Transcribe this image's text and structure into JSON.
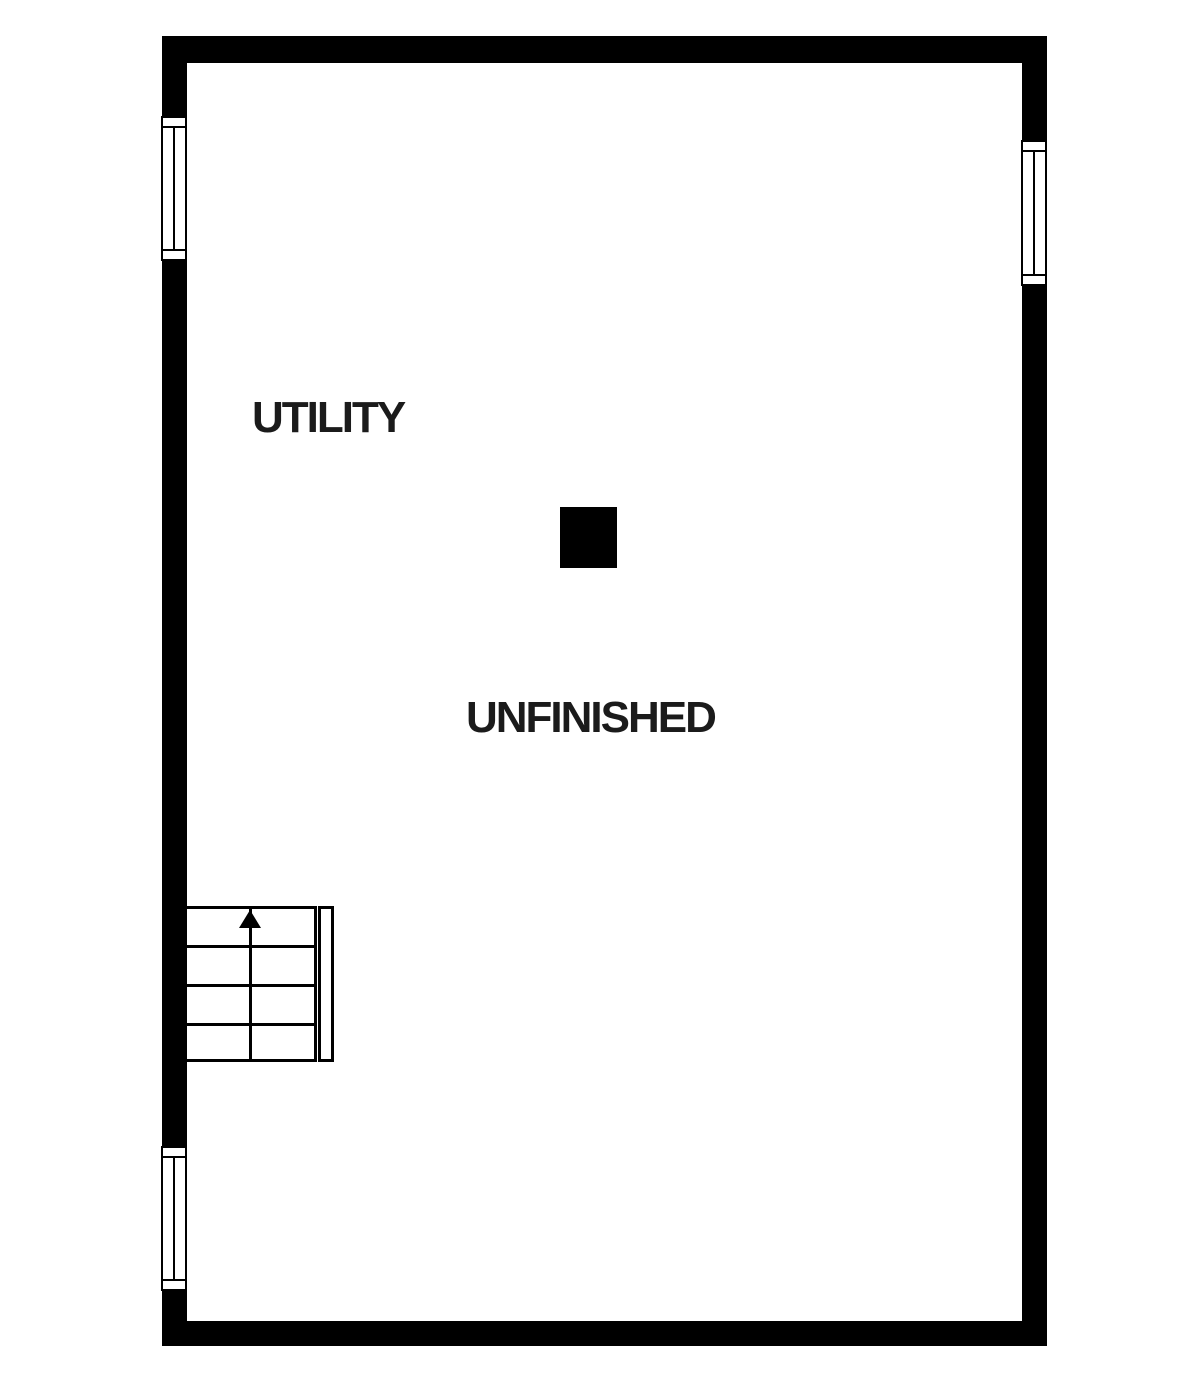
{
  "floorplan": {
    "colors": {
      "wall": "#000000",
      "background": "#ffffff",
      "text": "#1b1b1b"
    },
    "labels": {
      "utility": "UTILITY",
      "unfinished": "UNFINISHED"
    },
    "stairs": {
      "steps": 4,
      "direction_icon": "arrow-up-icon"
    },
    "windows": [
      {
        "id": "window-left-upper",
        "wall": "left"
      },
      {
        "id": "window-left-lower",
        "wall": "left"
      },
      {
        "id": "window-right",
        "wall": "right"
      }
    ],
    "column": {
      "type": "support-column"
    }
  }
}
